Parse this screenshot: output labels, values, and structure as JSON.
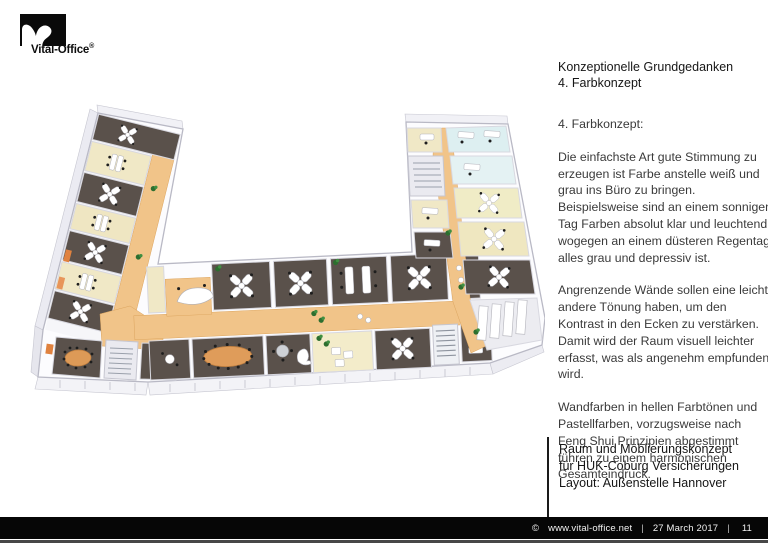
{
  "logo": {
    "brand": "Vital-Office",
    "registered": "®"
  },
  "heading": {
    "line1": "Konzeptionelle Grundgedanken",
    "line2": "4. Farbkonzept"
  },
  "body": {
    "intro": "4. Farbkonzept:",
    "paragraphs": [
      "Die einfachste Art gute Stimmung zu erzeugen ist Farbe anstelle weiß und grau ins Büro zu bringen. Beispielsweise sind an einem sonnigen Tag Farben absolut klar und leuchtend, wogegen an einem düsteren Regentag alles grau und depressiv ist.",
      "Angrenzende Wände sollen eine leicht andere Tönung haben, um den Kontrast in den Ecken zu verstärken. Damit wird der Raum visuell leichter erfasst, was als angenehm empfunden wird.",
      "Wandfarben in hellen Farbtönen und Pastellfarben, vorzugsweise nach Feng Shui Prinzipien abgestimmt führen zu einem harmonischen Gesamteindruck."
    ]
  },
  "project_block": {
    "line1": "Raum und Möblierungskonzept",
    "line2": "für HUK-Coburg Versicherungen",
    "line3": "Layout: Außenstelle Hannover"
  },
  "footer": {
    "copyright": "©",
    "url": "www.vital-office.net",
    "separator1": "|",
    "date": "27 March 2017",
    "separator2": "|",
    "page": "11"
  },
  "palette": {
    "corridor_orange": "#f1c489",
    "room_dark_brown": "#5a514b",
    "room_cream": "#f0e8c6",
    "room_light_cyan": "#ddeff1",
    "table_orange": "#df9c5a",
    "wall_gray": "#c6c6d0",
    "footer_black": "#060606",
    "plant_green": "#2d6e2f"
  }
}
